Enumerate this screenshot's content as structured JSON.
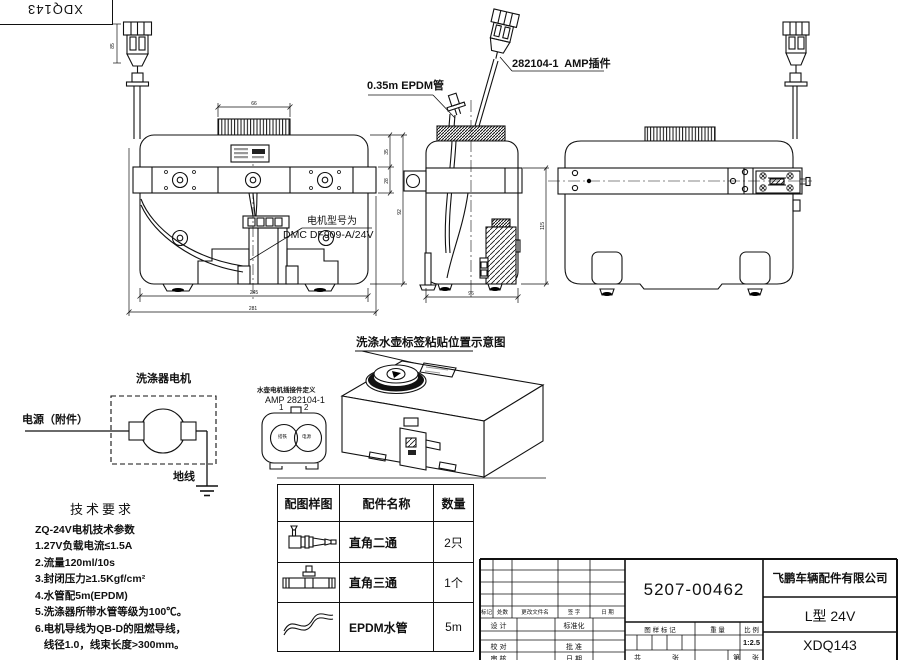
{
  "corner_stamp": {
    "code": "XDQ143"
  },
  "callouts": {
    "epdm_tube": "0.35m EPDM管",
    "amp_plug": "282104-1  AMP插件",
    "motor_model_caption": "电机型号为",
    "motor_model": "DMC DF909-A/24V",
    "label_diagram_title": "洗涤水壶标签粘贴位置示意图"
  },
  "connector_def": {
    "line1": "水壶电机插接件定义",
    "line2": "AMP 282104-1",
    "pin1": "1",
    "pin2": "2",
    "pin1_name": "搭铁",
    "pin2_name": "电源"
  },
  "circuit": {
    "motor": "洗涤器电机",
    "power": "电源（附件）",
    "ground": "地线"
  },
  "tech": {
    "heading": "技术要求",
    "lines": [
      "ZQ-24V电机技术参数",
      "1.27V负载电流≤1.5A",
      "2.流量120ml/10s",
      "3.封闭压力≥1.5Kgf/cm²",
      "4.水管配5m(EPDM)",
      "5.洗涤器所带水管等级为100℃。",
      "6.电机导线为QB-D的阻燃导线，",
      "   线径1.0，线束长度>300mm。"
    ]
  },
  "parts_table": {
    "headers": [
      "配图样图",
      "配件名称",
      "数量"
    ],
    "rows": [
      {
        "icon": "elbow-two-way-fitting",
        "name": "直角二通",
        "qty": "2只"
      },
      {
        "icon": "tee-three-way-fitting",
        "name": "直角三通",
        "qty": "1个"
      },
      {
        "icon": "epdm-hose",
        "name": "EPDM水管",
        "qty": "5m"
      }
    ]
  },
  "title_block": {
    "part_number": "5207-00462",
    "company": "飞鹏车辆配件有限公司",
    "model": "L型 24V",
    "drawing_no": "XDQ143",
    "scale": "1:2.5",
    "labels": {
      "mark": "标记",
      "count": "处数",
      "changed_file": "更改文件名",
      "sign": "签 字",
      "date": "日 期",
      "design": "设 计",
      "standardize": "标准化",
      "check": "校 对",
      "approve": "批 准",
      "review": "审 核",
      "date2": "日 期",
      "drawing_mark": "图 样 标 记",
      "weight": "重 量",
      "scale_label": "比 例",
      "total": "共",
      "sheet": "张",
      "page": "第",
      "sheet2": "张"
    }
  },
  "dims": {
    "cap_width": "66",
    "h1": "35",
    "h2": "28",
    "h3": "92",
    "w1": "245",
    "w2": "281",
    "side_width": "96",
    "side_height": "115",
    "connector_len": "85"
  }
}
